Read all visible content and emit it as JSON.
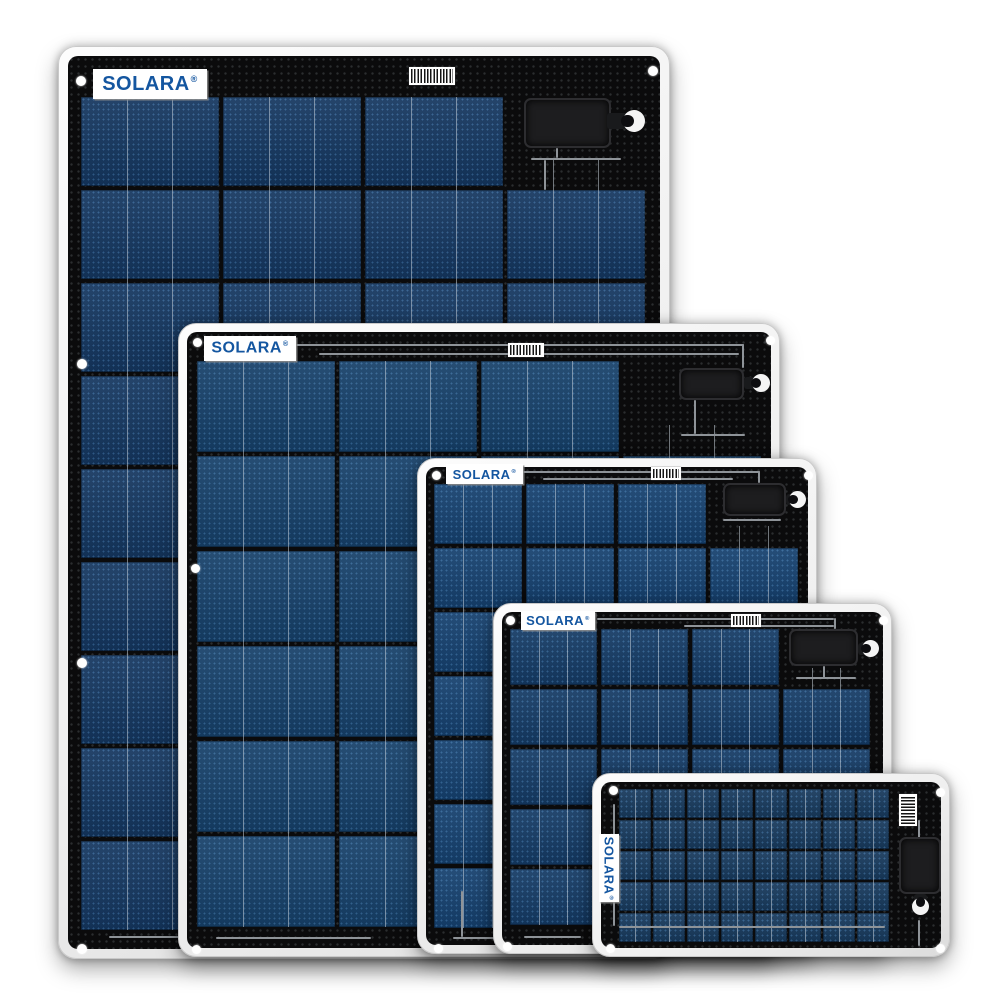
{
  "scene": {
    "description": "Product photo: five SOLARA flexible marine solar panels of decreasing size, overlapped left-to-right on a white background",
    "background_color": "#ffffff",
    "panel_frame_color": "#f0f0f0",
    "panel_face_color": "#0b0b0c",
    "cell_blue": "#16406c",
    "logo_color": "#1456a0",
    "wire_color": "#8e9398"
  },
  "brand": {
    "logo_text": "SOLARA",
    "registered_mark": "®"
  },
  "panels": [
    {
      "data_name": "solar-panel-1-largest",
      "logo": {
        "text": "SOLARA",
        "reg": "®",
        "vertical": false,
        "x": 34,
        "y": 22,
        "w": 114,
        "h": 30,
        "font": 20
      },
      "layout": {
        "x": 58,
        "y": 46,
        "w": 610,
        "h": 911,
        "z": 1,
        "face_inset": 9
      },
      "barcode": {
        "x": 350,
        "y": 20,
        "w": 46,
        "h": 18,
        "vertical": false
      },
      "junction_box": {
        "x": 465,
        "y": 51,
        "w": 87,
        "h": 50
      },
      "cable": {
        "x": 548,
        "y": 66,
        "w": 22,
        "h": 16
      },
      "grommet": {
        "x": 564,
        "y": 63,
        "d": 22,
        "open": "left"
      },
      "holes": [
        [
          17,
          29
        ],
        [
          589,
          19
        ],
        [
          18,
          312
        ],
        [
          589,
          312
        ],
        [
          18,
          611
        ],
        [
          589,
          611
        ],
        [
          18,
          897
        ],
        [
          589,
          897
        ]
      ],
      "hole_d": 10,
      "cells": {
        "x": 22,
        "y": 50,
        "cols": 4,
        "rows": 9,
        "cw": 138,
        "ch": 89,
        "gx": 4,
        "gy": 4,
        "base": "#14365f",
        "bus": [
          0.33,
          0.66
        ],
        "cutouts": [
          [
            0,
            3
          ]
        ]
      },
      "wires": [
        [
          472,
          111,
          90,
          2
        ],
        [
          497,
          101,
          2,
          10
        ],
        [
          50,
          889,
          240,
          2
        ],
        [
          485,
          113,
          2,
          30
        ]
      ]
    },
    {
      "data_name": "solar-panel-2",
      "logo": {
        "text": "SOLARA",
        "reg": "®",
        "vertical": false,
        "x": 25,
        "y": 12,
        "w": 92,
        "h": 25,
        "font": 16
      },
      "layout": {
        "x": 178,
        "y": 323,
        "w": 600,
        "h": 632,
        "z": 2,
        "face_inset": 8
      },
      "barcode": {
        "x": 329,
        "y": 19,
        "w": 36,
        "h": 14,
        "vertical": false
      },
      "junction_box": {
        "x": 500,
        "y": 44,
        "w": 65,
        "h": 32
      },
      "cable": {
        "x": 565,
        "y": 53,
        "w": 14,
        "h": 12
      },
      "grommet": {
        "x": 573,
        "y": 50,
        "d": 18,
        "open": "left"
      },
      "holes": [
        [
          14,
          14
        ],
        [
          587,
          12
        ],
        [
          12,
          240
        ],
        [
          13,
          621
        ],
        [
          587,
          621
        ]
      ],
      "hole_d": 9,
      "cells": {
        "x": 18,
        "y": 37,
        "cols": 4,
        "rows": 6,
        "cw": 138,
        "ch": 91,
        "gx": 4,
        "gy": 4,
        "base": "#164069",
        "bus": [
          0.33,
          0.66
        ],
        "cutouts": [
          [
            0,
            3
          ]
        ]
      },
      "wires": [
        [
          117,
          20,
          448,
          2
        ],
        [
          140,
          29,
          420,
          2
        ],
        [
          563,
          20,
          2,
          24
        ],
        [
          515,
          76,
          2,
          34
        ],
        [
          502,
          110,
          64,
          2
        ],
        [
          37,
          613,
          155,
          2
        ]
      ]
    },
    {
      "data_name": "solar-panel-3",
      "logo": {
        "text": "SOLARA",
        "reg": "®",
        "vertical": false,
        "x": 28,
        "y": 5,
        "w": 77,
        "h": 20,
        "font": 13
      },
      "layout": {
        "x": 417,
        "y": 458,
        "w": 398,
        "h": 494,
        "z": 3,
        "face_inset": 8
      },
      "barcode": {
        "x": 233,
        "y": 8,
        "w": 30,
        "h": 13,
        "vertical": false
      },
      "junction_box": {
        "x": 305,
        "y": 24,
        "w": 63,
        "h": 33
      },
      "cable": {
        "x": 368,
        "y": 35,
        "w": 10,
        "h": 11
      },
      "grommet": {
        "x": 371,
        "y": 32,
        "d": 17,
        "open": "left"
      },
      "holes": [
        [
          14,
          12
        ],
        [
          386,
          12
        ],
        [
          16,
          485
        ],
        [
          386,
          485
        ]
      ],
      "hole_d": 9,
      "cells": {
        "x": 16,
        "y": 25,
        "cols": 4,
        "rows": 7,
        "cw": 88,
        "ch": 60,
        "gx": 4,
        "gy": 4,
        "base": "#15406e",
        "bus": [
          0.33,
          0.66
        ],
        "cutouts": [
          [
            0,
            3
          ]
        ]
      },
      "wires": [
        [
          105,
          12,
          237,
          2
        ],
        [
          340,
          12,
          2,
          12
        ],
        [
          125,
          19,
          190,
          2
        ],
        [
          305,
          60,
          58,
          2
        ],
        [
          35,
          478,
          148,
          2
        ],
        [
          43,
          432,
          2,
          46
        ]
      ]
    },
    {
      "data_name": "solar-panel-4",
      "logo": {
        "text": "SOLARA",
        "reg": "®",
        "vertical": false,
        "x": 27,
        "y": 7,
        "w": 74,
        "h": 19,
        "font": 13
      },
      "layout": {
        "x": 493,
        "y": 603,
        "w": 397,
        "h": 349,
        "z": 4,
        "face_inset": 8
      },
      "barcode": {
        "x": 237,
        "y": 10,
        "w": 30,
        "h": 13,
        "vertical": false
      },
      "junction_box": {
        "x": 295,
        "y": 25,
        "w": 69,
        "h": 37
      },
      "cable": {
        "x": 364,
        "y": 39,
        "w": 12,
        "h": 12
      },
      "grommet": {
        "x": 368,
        "y": 36,
        "d": 17,
        "open": "left"
      },
      "holes": [
        [
          12,
          12
        ],
        [
          385,
          12
        ],
        [
          9,
          338
        ],
        [
          385,
          338
        ]
      ],
      "hole_d": 9,
      "cells": {
        "x": 16,
        "y": 25,
        "cols": 4,
        "rows": 5,
        "cw": 87,
        "ch": 56,
        "gx": 4,
        "gy": 4,
        "base": "#143a64",
        "bus": [
          0.33,
          0.66
        ],
        "cutouts": [
          [
            0,
            3
          ]
        ]
      },
      "wires": [
        [
          103,
          14,
          237,
          2
        ],
        [
          340,
          14,
          2,
          11
        ],
        [
          190,
          21,
          150,
          2
        ],
        [
          329,
          62,
          2,
          12
        ],
        [
          302,
          73,
          60,
          2
        ],
        [
          30,
          332,
          57,
          2
        ]
      ]
    },
    {
      "data_name": "solar-panel-5-smallest",
      "logo": {
        "text": "SOLARA",
        "reg": "®",
        "vertical": true,
        "x": 6,
        "y": 60,
        "w": 20,
        "h": 68,
        "font": 13
      },
      "layout": {
        "x": 592,
        "y": 773,
        "w": 356,
        "h": 182,
        "z": 5,
        "face_inset": 8
      },
      "barcode": {
        "x": 306,
        "y": 20,
        "w": 18,
        "h": 32,
        "vertical": true
      },
      "junction_box": {
        "x": 306,
        "y": 63,
        "w": 42,
        "h": 57
      },
      "cable": {
        "x": 321,
        "y": 120,
        "w": 13,
        "h": 12
      },
      "grommet": {
        "x": 319,
        "y": 124,
        "d": 17,
        "open": "up"
      },
      "holes": [
        [
          16,
          12
        ],
        [
          343,
          14
        ],
        [
          13,
          170
        ],
        [
          343,
          170
        ]
      ],
      "hole_d": 9,
      "cells": {
        "x": 26,
        "y": 15,
        "cols": 8,
        "rows": 5,
        "cw": 32,
        "ch": 29,
        "gx": 2,
        "gy": 2,
        "base": "#17395c",
        "bus": [
          0.5
        ],
        "cutouts": []
      },
      "wires": [
        [
          325,
          46,
          2,
          18
        ],
        [
          325,
          146,
          2,
          26
        ],
        [
          26,
          152,
          266,
          2
        ],
        [
          20,
          30,
          2,
          122
        ]
      ]
    }
  ]
}
